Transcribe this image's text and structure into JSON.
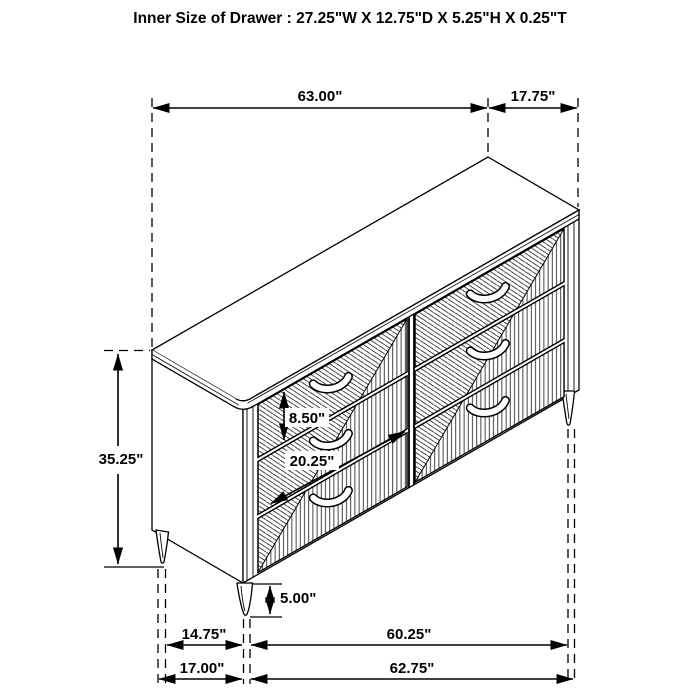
{
  "title": "Inner Size of Drawer : 27.25\"W X 12.75\"D X 5.25\"H X 0.25\"T",
  "dimensions": {
    "width_top": "63.00\"",
    "depth_top": "17.75\"",
    "overall_height": "35.25\"",
    "drawer_front_height": "8.50\"",
    "drawer_front_width": "20.25\"",
    "leg_height": "5.00\"",
    "leg_span_depth": "14.75\"",
    "leg_span_width": "60.25\"",
    "base_depth": "17.00\"",
    "base_width": "62.75\""
  },
  "colors": {
    "line": "#000000",
    "background": "#ffffff",
    "text": "#000000"
  }
}
